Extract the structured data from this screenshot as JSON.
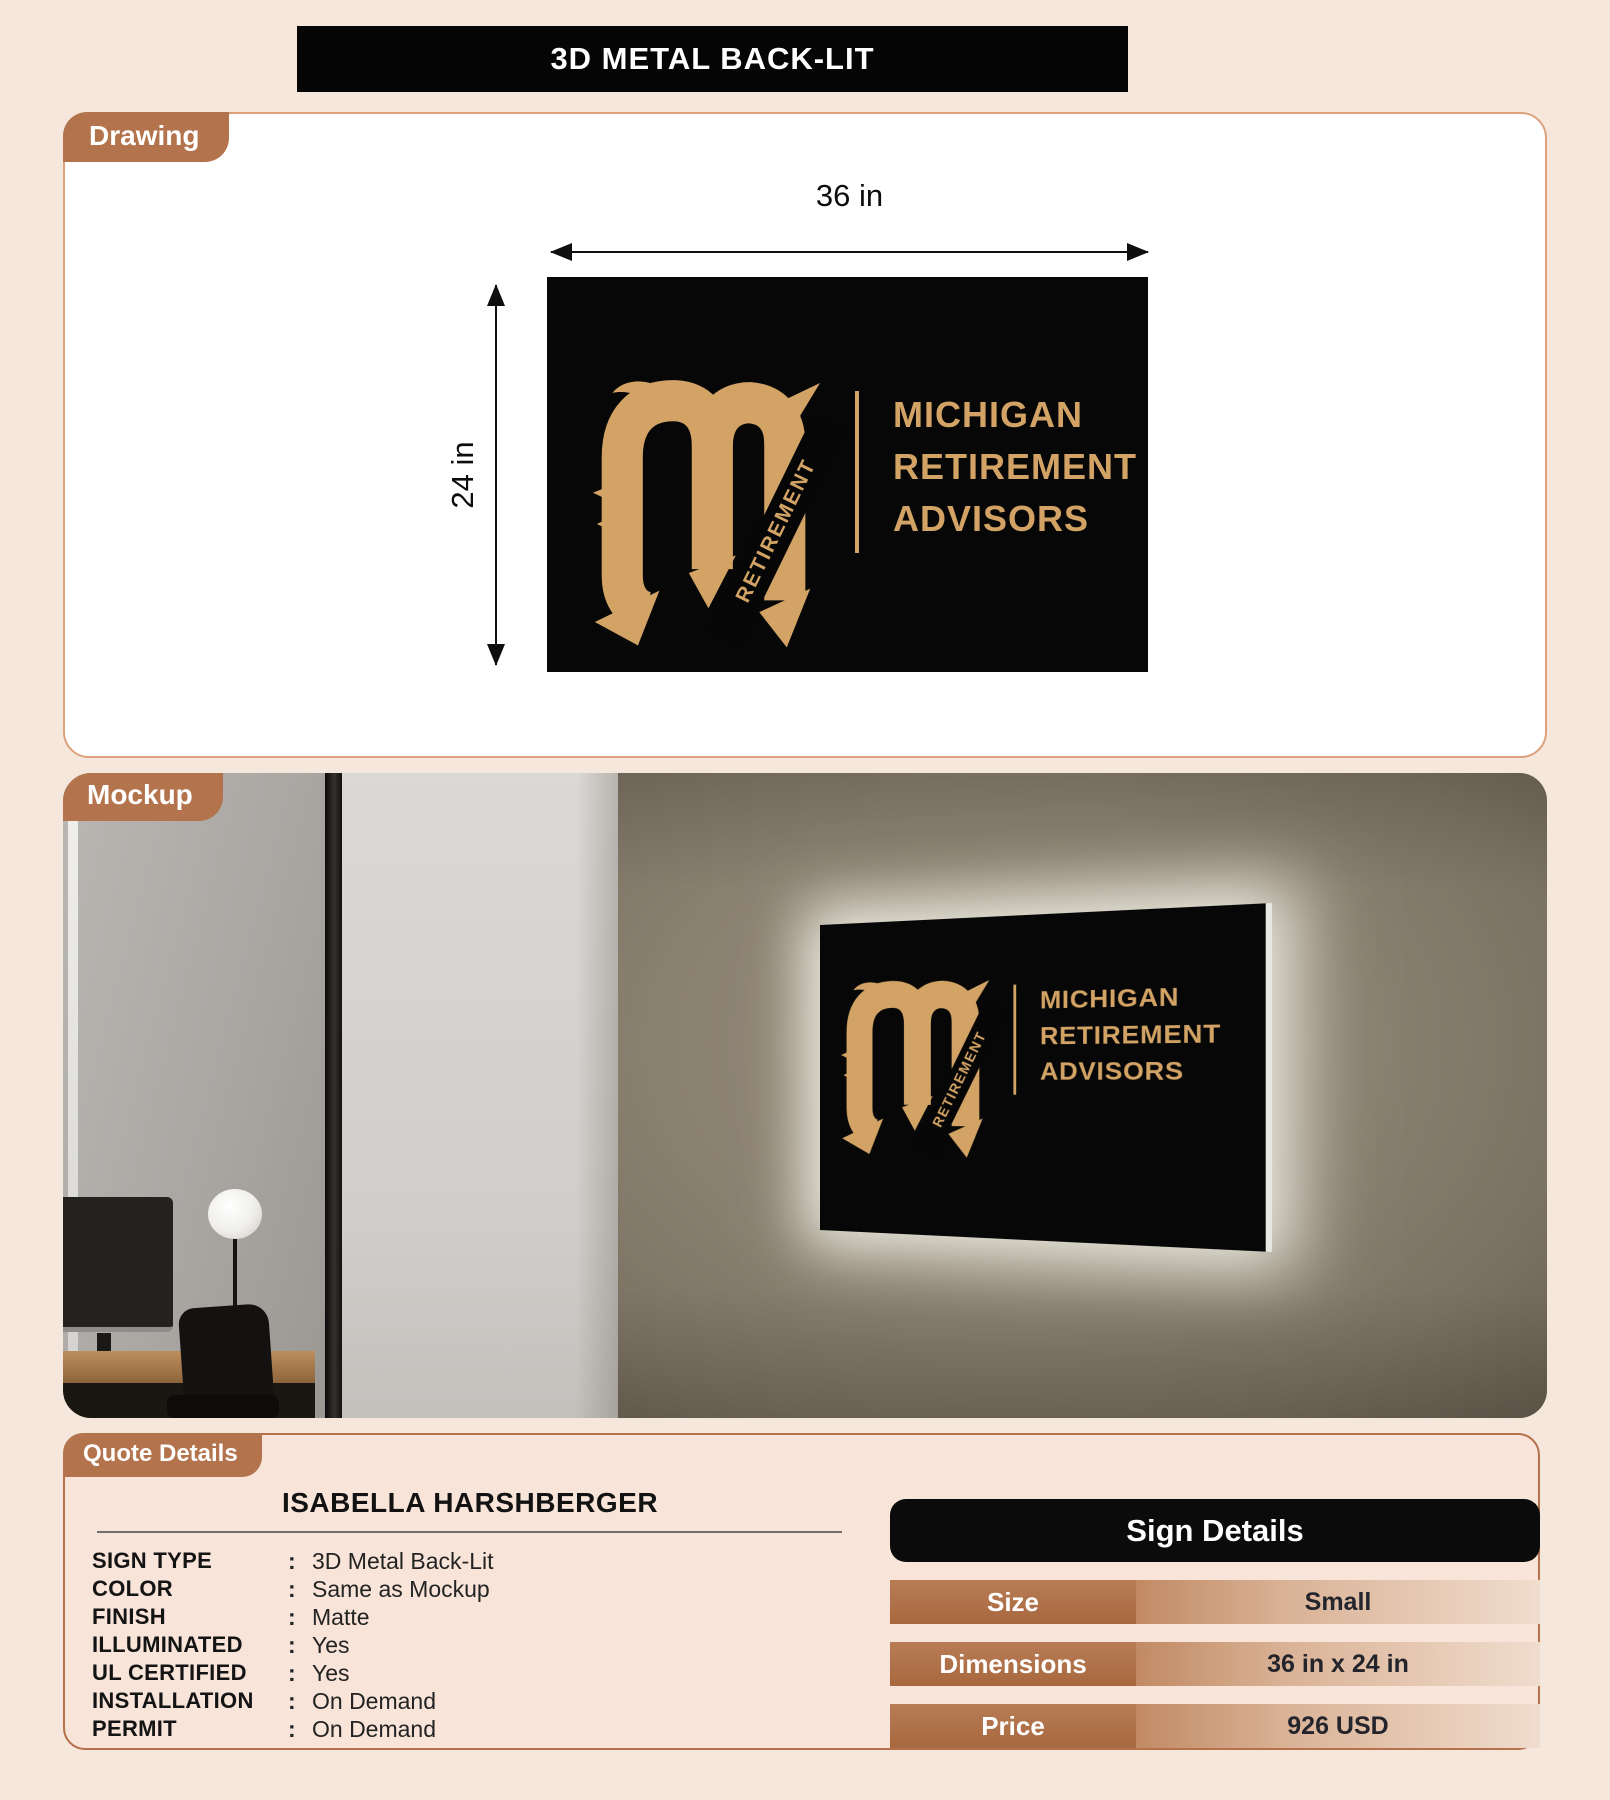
{
  "header": {
    "title": "3D METAL BACK-LIT"
  },
  "drawing": {
    "tab_label": "Drawing",
    "width_label": "36 in",
    "height_label": "24 in"
  },
  "logo": {
    "monogram_letter": "M",
    "monogram_text": "RETIREMENT",
    "lines": [
      "MICHIGAN",
      "RETIREMENT",
      "ADVISORS"
    ]
  },
  "mockup": {
    "tab_label": "Mockup"
  },
  "quote": {
    "tab_label": "Quote Details",
    "customer_name": "ISABELLA HARSHBERGER",
    "separator": ":",
    "fields": [
      {
        "key": "SIGN TYPE",
        "value": "3D Metal Back-Lit"
      },
      {
        "key": "COLOR",
        "value": "Same as Mockup"
      },
      {
        "key": "FINISH",
        "value": "Matte"
      },
      {
        "key": "ILLUMINATED",
        "value": "Yes"
      },
      {
        "key": "UL CERTIFIED",
        "value": "Yes"
      },
      {
        "key": "INSTALLATION",
        "value": "On Demand"
      },
      {
        "key": "PERMIT",
        "value": "On Demand"
      }
    ],
    "sign_details": {
      "title": "Sign Details",
      "rows": [
        {
          "label": "Size",
          "value": "Small"
        },
        {
          "label": "Dimensions",
          "value": "36 in x 24 in"
        },
        {
          "label": "Price",
          "value": "926 USD"
        }
      ]
    }
  },
  "colors": {
    "accent_brown": "#b3734c",
    "gold": "#d2a365",
    "sign_black": "#070707",
    "page_background": "#f6e7dc"
  }
}
